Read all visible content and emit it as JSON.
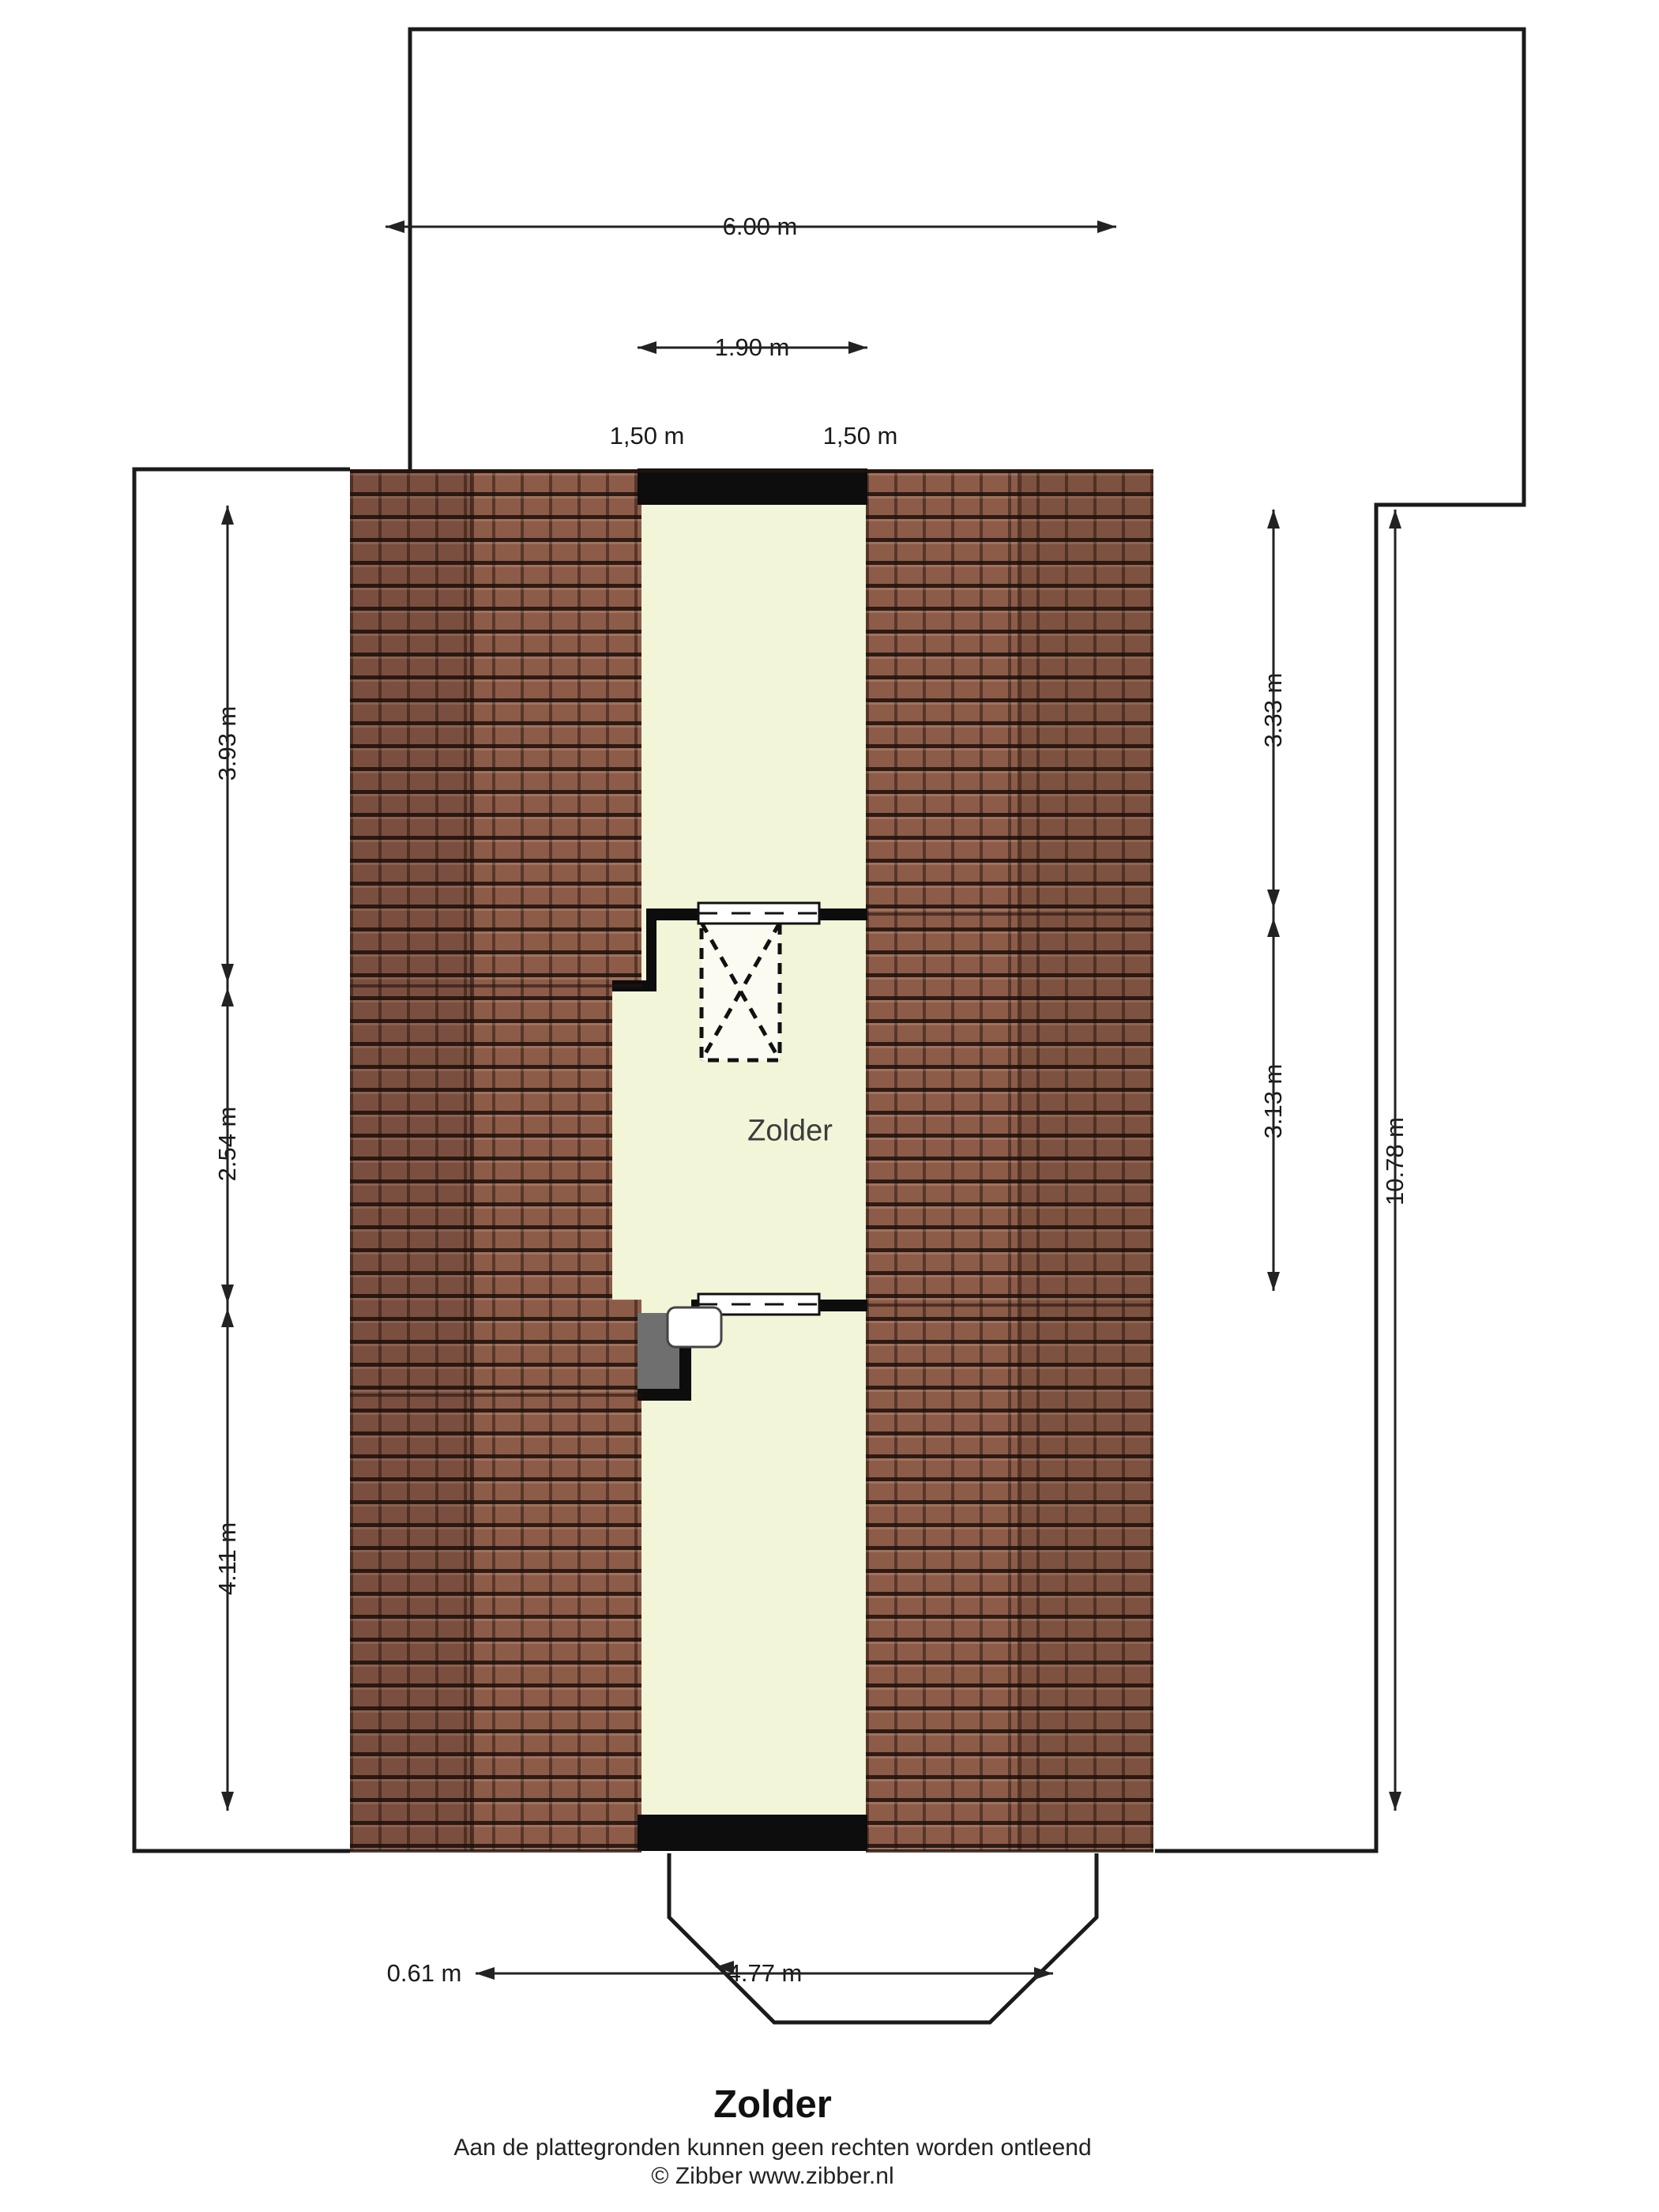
{
  "plan": {
    "room_label": "Zolder"
  },
  "dimensions": {
    "top_width": "6.00 m",
    "stair_opening_width": "1.90 m",
    "slope_left": "1,50 m",
    "slope_right": "1,50 m",
    "left_top": "3.93 m",
    "left_middle": "2.54 m",
    "left_bottom": "4.11 m",
    "right_top": "3.33 m",
    "right_middle": "3.13 m",
    "right_total": "10.78 m",
    "bottom_offset": "0.61 m",
    "bottom_bay_width": "4.77 m"
  },
  "footer": {
    "title": "Zolder",
    "disclaimer": "Aan de plattegronden kunnen geen rechten worden ontleend",
    "copyright": "© Zibber www.zibber.nl"
  },
  "colors": {
    "room_fill": "#f2f5d8",
    "roof_tile": "#8d5c49",
    "wall": "#0d0d0d",
    "outline": "#1a1a1a",
    "gray_box": "#6f6f6f"
  }
}
